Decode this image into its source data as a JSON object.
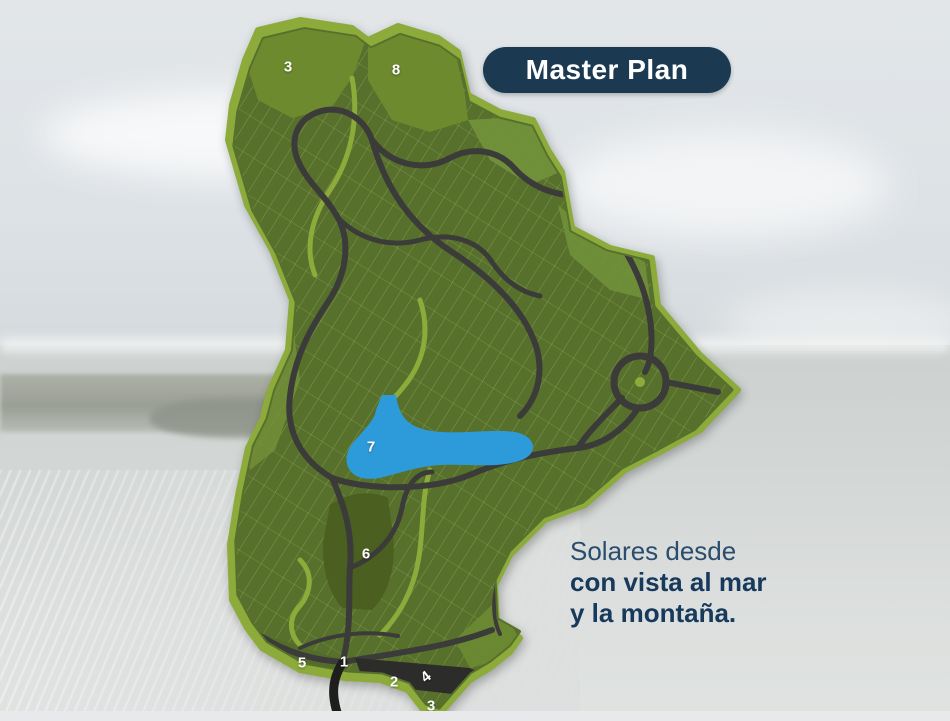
{
  "badge": {
    "label": "Master Plan",
    "bg_color": "#1b3a52",
    "text_color": "#ffffff"
  },
  "tagline": {
    "line1": "Solares desde",
    "line2": "con vista al mar",
    "line3": "y la montaña.",
    "color": "#16395c"
  },
  "map": {
    "zones": [
      {
        "id": "zone-3-top",
        "label": "3"
      },
      {
        "id": "zone-8",
        "label": "8"
      },
      {
        "id": "zone-7-lake",
        "label": "7"
      },
      {
        "id": "zone-6",
        "label": "6"
      },
      {
        "id": "zone-5",
        "label": "5"
      },
      {
        "id": "zone-1",
        "label": "1"
      },
      {
        "id": "zone-2",
        "label": "2"
      },
      {
        "id": "zone-4",
        "label": "4"
      },
      {
        "id": "zone-3-bottom",
        "label": "3"
      }
    ],
    "colors": {
      "border_green": "#8cab3b",
      "parcel_green": "#57712c",
      "open_green": "#6f8c31",
      "dark_green": "#4a5f20",
      "road_gray": "#3b3b39",
      "access_black": "#1e1e1c",
      "lake_blue": "#2d9bd9"
    }
  }
}
